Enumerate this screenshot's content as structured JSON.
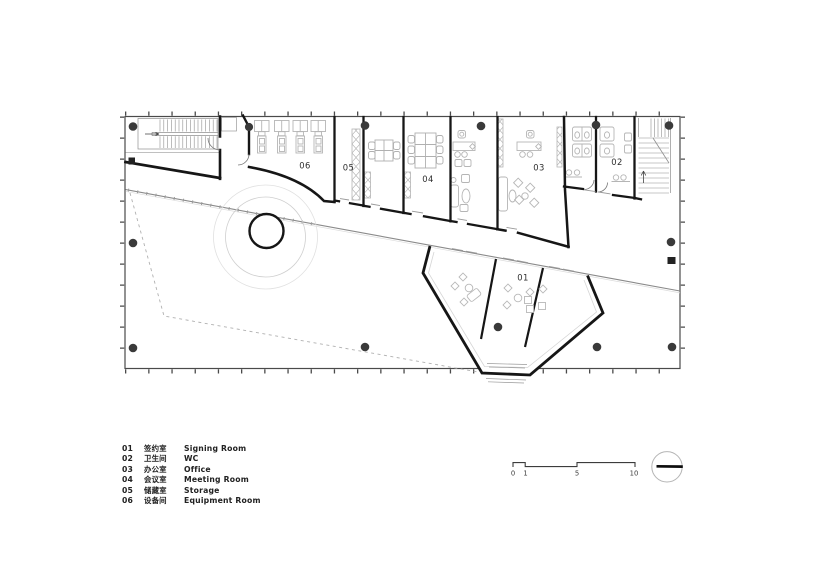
{
  "plan": {
    "room_labels": {
      "r01": "01",
      "r02": "02",
      "r03": "03",
      "r04": "04",
      "r05": "05",
      "r06": "06"
    }
  },
  "legend": {
    "items": [
      {
        "num": "01",
        "zh": "签约室",
        "en": "Signing Room"
      },
      {
        "num": "02",
        "zh": "卫生间",
        "en": "WC"
      },
      {
        "num": "03",
        "zh": "办公室",
        "en": "Office"
      },
      {
        "num": "04",
        "zh": "会议室",
        "en": "Meeting Room"
      },
      {
        "num": "05",
        "zh": "储藏室",
        "en": "Storage"
      },
      {
        "num": "06",
        "zh": "设备间",
        "en": "Equipment Room"
      }
    ]
  },
  "scale_bar": {
    "ticks": [
      "0",
      "1",
      "5",
      "10"
    ]
  },
  "colors": {
    "wall": "#161616",
    "thin_line": "#8a8a8a",
    "furniture": "#b5b5b5",
    "column": "#3a3a3a"
  }
}
